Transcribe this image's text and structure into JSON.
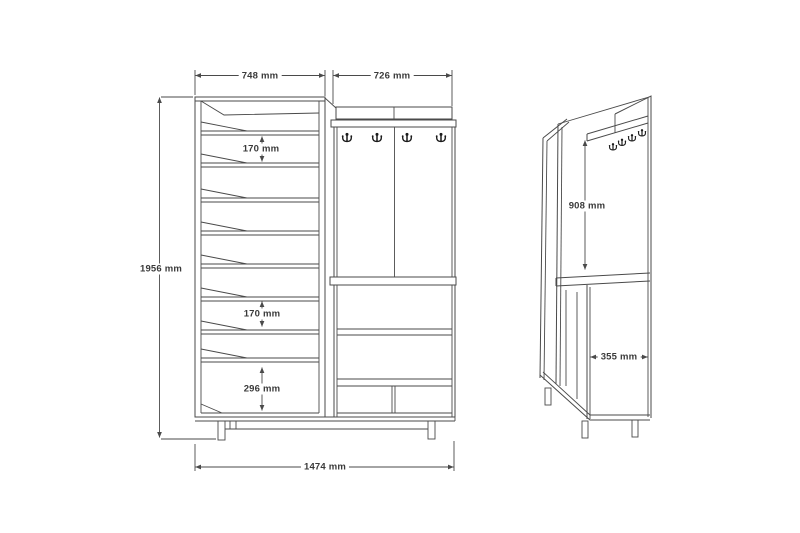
{
  "colors": {
    "line": "#4a4a4a",
    "text": "#3a3a3a",
    "hook": "#1c1c1c",
    "background": "#ffffff"
  },
  "diagram": {
    "type": "furniture-dimension-drawing",
    "subject": "hallway unit with shoe rack, coat hook panel and open shelves",
    "icons": {
      "coat_hook": "double-prong-coat-hook-icon"
    },
    "views": {
      "front": {
        "labels": {
          "width_left": "748 mm",
          "width_right": "726 mm",
          "height_total": "1956 mm",
          "shelf_gap_upper": "170 mm",
          "shelf_gap_lower": "170 mm",
          "bottom_compartment": "296 mm",
          "width_total": "1474 mm"
        }
      },
      "side": {
        "labels": {
          "hook_panel_height": "908 mm",
          "depth": "355 mm"
        }
      }
    }
  }
}
